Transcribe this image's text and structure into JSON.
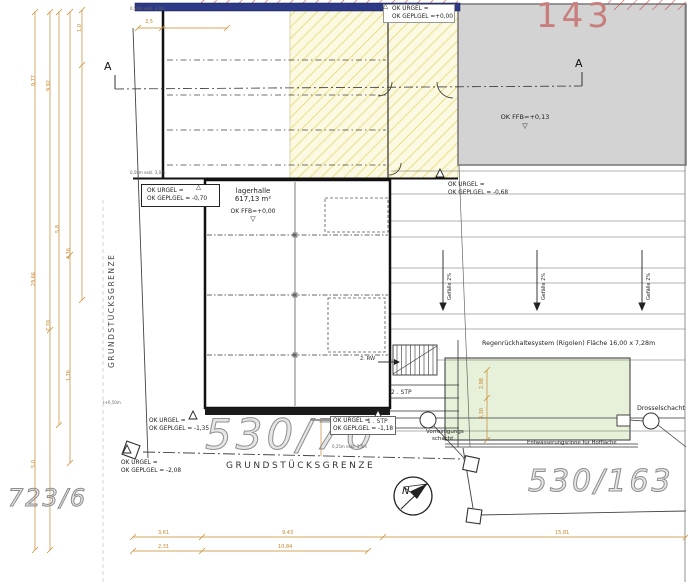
{
  "parcels": {
    "top_right": "143",
    "bottom_left": "723/6",
    "center": "530/70",
    "bottom_right": "530/163"
  },
  "buildings": {
    "lagerhalle": {
      "name": "lagerhalle",
      "area": "617,13 m²",
      "ffb": "OK FFB=+0,00"
    },
    "existing": {
      "ffb": "OK FFB=+0,13"
    }
  },
  "levels": {
    "top": {
      "l1": "OK URGEL =",
      "l2": "OK GEPLGEL =+0,00"
    },
    "hall_left": {
      "l1": "OK URGEL =",
      "l2": "OK GEPLGEL = -0,70"
    },
    "yard": {
      "l1": "OK URGEL =",
      "l2": "OK GEPLGEL = -0,68"
    },
    "south1": {
      "l1": "OK URGEL =",
      "l2": "OK GEPLGEL = -1,35"
    },
    "south2": {
      "l1": "OK URGEL =",
      "l2": "OK GEPLGEL = -1,18"
    },
    "south3": {
      "l1": "OK URGEL =",
      "l2": "OK GEPLGEL = -2,08"
    }
  },
  "boundary": {
    "left": "GRUNDSTÜCKSGRENZE",
    "bottom": "GRUNDSTÜCKSGRENZE"
  },
  "yard": {
    "slope": "Gefälle 2%"
  },
  "drainage": {
    "rigole_title": "Regenrückhaltesystem (Rigolen) Fläche 16,00 x 7,28m",
    "drosselschacht": "Drosselschacht",
    "rinne": "Entwässerungsrinne für Hoffläche",
    "vorreinigung_l1": "Vorreinigungs",
    "vorreinigung_l2": "schacht"
  },
  "annex": {
    "stp2": "2 . STP",
    "stp1": "1 . STP",
    "rw": "2. RW"
  },
  "section": {
    "a_left": "A",
    "a_right": "A"
  },
  "north_label": "N",
  "markers": {
    "up": "△",
    "down": "▽"
  },
  "dims": {
    "left": [
      "9,77",
      "9,92",
      "1,0",
      "5,8",
      "4,76",
      "29,66",
      "7,70",
      "1,76",
      "5,0"
    ],
    "hall_top": "3,5",
    "bottom_row1": [
      "3,61",
      "9,43",
      "15,81"
    ],
    "bottom_row2": [
      "2,31",
      "10,84"
    ],
    "rigole": [
      "2,98",
      "4,30"
    ]
  },
  "notes": {
    "n1": "0,50m exkl. 3,0m",
    "n2": "0,50m exkl. 3,0m",
    "n3": "t+0,50m",
    "n4": "0,25m exkl. 3,0m"
  },
  "colors": {
    "dimension": "#c8872a",
    "parcel_red": "#c97e7e",
    "wall_navy": "#2c3a87",
    "yellow_area": "#fcf9e2",
    "gray_building": "#d3d3d3",
    "green_area": "#e7f0d9"
  }
}
